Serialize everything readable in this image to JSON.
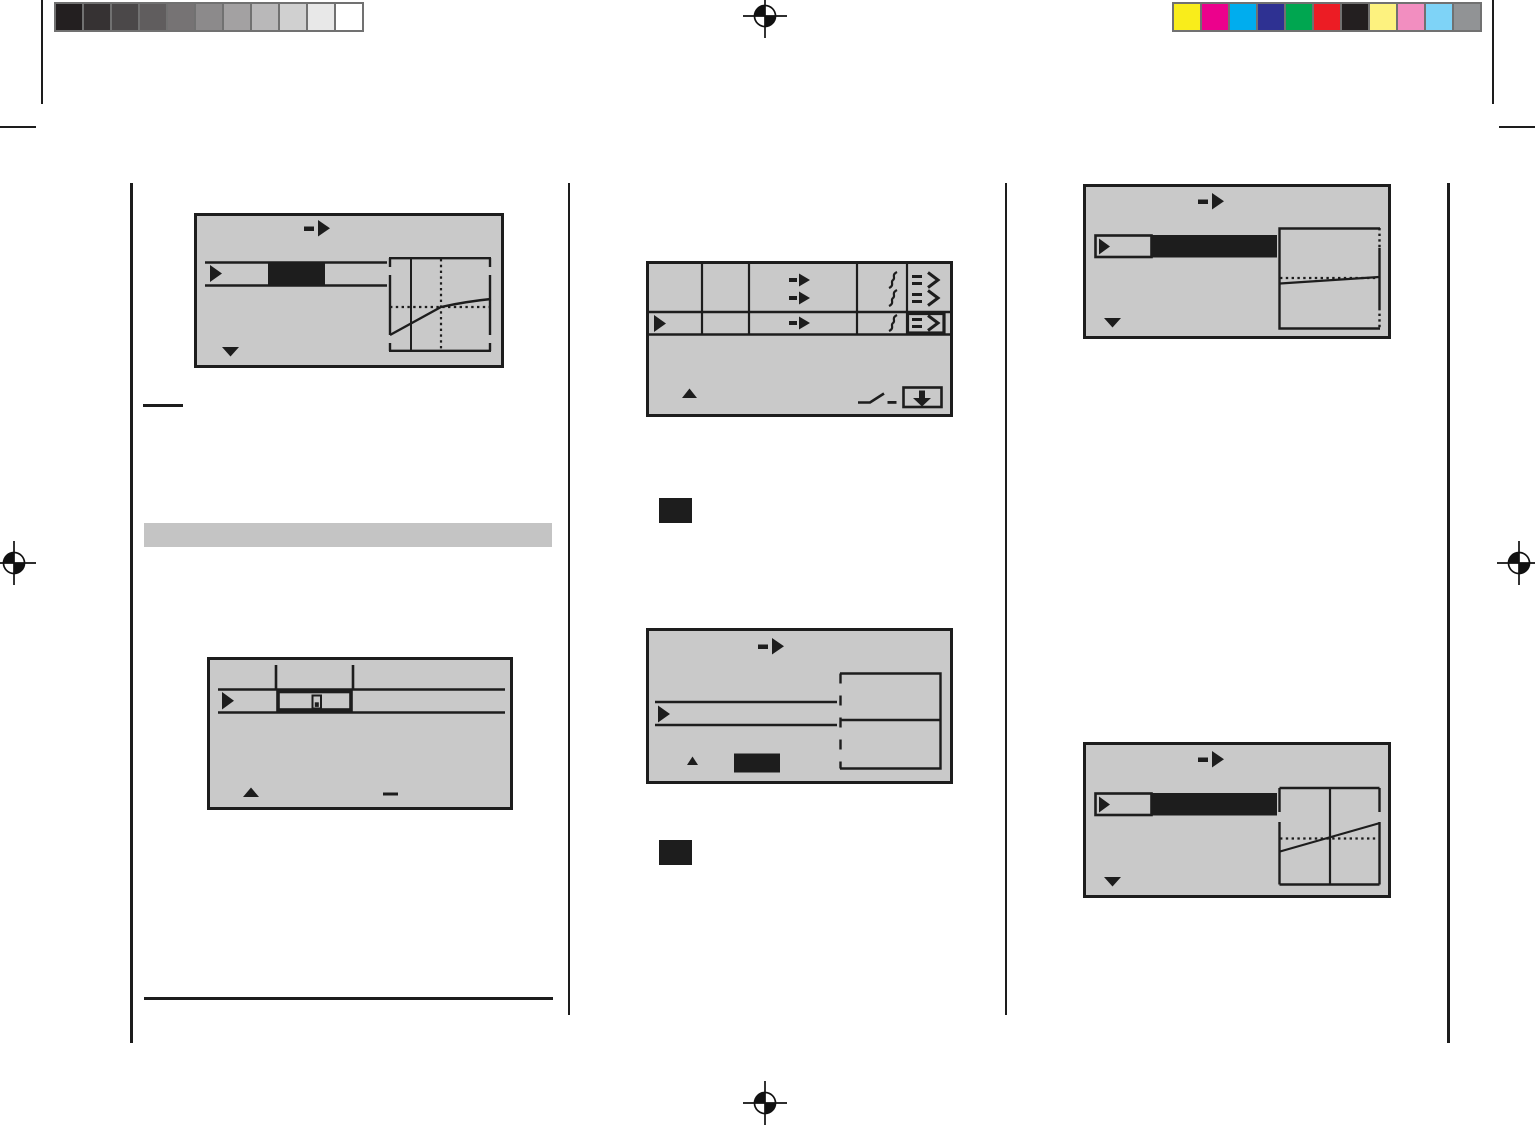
{
  "calibration": {
    "grayscale_strip": [
      "#231f20",
      "#363233",
      "#4b4849",
      "#605d5e",
      "#767374",
      "#8c8a8b",
      "#a3a1a2",
      "#b9b8b9",
      "#d0d0d0",
      "#e8e8e8",
      "#ffffff"
    ],
    "color_strip": [
      "#f9ed1b",
      "#ec018c",
      "#00adee",
      "#2e3192",
      "#00a650",
      "#ec1c24",
      "#231f20",
      "#fdf27f",
      "#f28ec0",
      "#7ed3f7",
      "#919395"
    ],
    "strip_border_color": "#717171"
  },
  "colors": {
    "page_background": "#ffffff",
    "lcd_background": "#c9c9c9",
    "ink": "#1d1d1d",
    "section_bar": "#c4c4c4"
  },
  "marks": {
    "registration": [
      "top-center",
      "left-middle",
      "right-middle",
      "bottom-center"
    ],
    "trim": [
      "top-left-vertical",
      "top-left-horizontal",
      "top-right-vertical",
      "top-right-horizontal"
    ]
  },
  "columns": [
    {
      "id": "left",
      "screens": [
        {
          "id": "lcd-screen-rate-curve",
          "icons": [
            "arrow-next-icon",
            "cursor-icon",
            "selected-value-block",
            "rate-graph",
            "scroll-down-icon"
          ]
        },
        {
          "id": "lcd-screen-trim-display",
          "icons": [
            "cursor-icon",
            "trim-selector-box",
            "trim-indicator-icon",
            "scroll-up-icon",
            "minus-dash-icon"
          ]
        }
      ],
      "extras": [
        "note-underline",
        "section-header-bar",
        "footer-rule"
      ]
    },
    {
      "id": "middle",
      "screens": [
        {
          "id": "lcd-screen-mix-table",
          "icons": [
            "cursor-icon",
            "arrow-next-icon",
            "squiggle-icon",
            "equals-angle-icon",
            "selected-cell-box",
            "scroll-up-icon",
            "ramp-icon",
            "store-icon"
          ]
        },
        {
          "id": "lcd-screen-dashed-panel",
          "icons": [
            "arrow-next-icon",
            "cursor-icon",
            "dashed-panel-box",
            "scroll-up-icon",
            "selected-value-block"
          ]
        }
      ],
      "extras": [
        "key-button-blank-1",
        "key-button-blank-2"
      ]
    },
    {
      "id": "right",
      "screens": [
        {
          "id": "lcd-screen-flat-curve",
          "icons": [
            "arrow-next-icon",
            "cursor-icon",
            "selected-value-block",
            "flat-curve-graph",
            "scroll-down-icon"
          ]
        },
        {
          "id": "lcd-screen-linear-curve",
          "icons": [
            "arrow-next-icon",
            "cursor-icon",
            "selected-value-block",
            "linear-curve-graph",
            "scroll-down-icon"
          ]
        }
      ],
      "extras": []
    }
  ]
}
